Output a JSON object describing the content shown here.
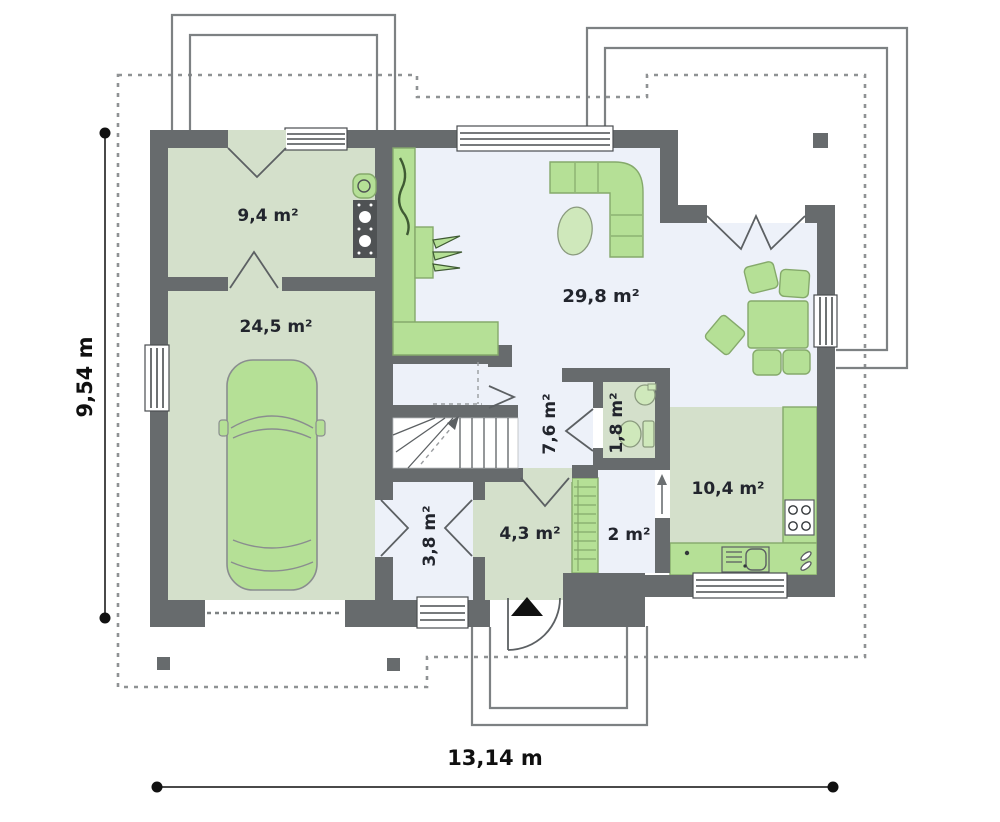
{
  "plan": {
    "dimension_labels": {
      "height": "9,54 m",
      "width": "13,14 m"
    },
    "room_labels": {
      "boiler_room": "9,4 m²",
      "garage": "24,5 m²",
      "living_room": "29,8 m²",
      "hall": "7,6 m²",
      "wc": "1,8 m²",
      "storage": "3,8 m²",
      "vestibule": "4,3 m²",
      "pantry": "2 m²",
      "kitchen": "10,4 m²"
    },
    "colors": {
      "wall": "#676b6d",
      "floor-green": "#d4e0cb",
      "floor-blue": "#edf1f9",
      "furniture-green": "#b5e096",
      "furniture-stroke": "#85a96b",
      "label-ink": "#22252d"
    }
  }
}
